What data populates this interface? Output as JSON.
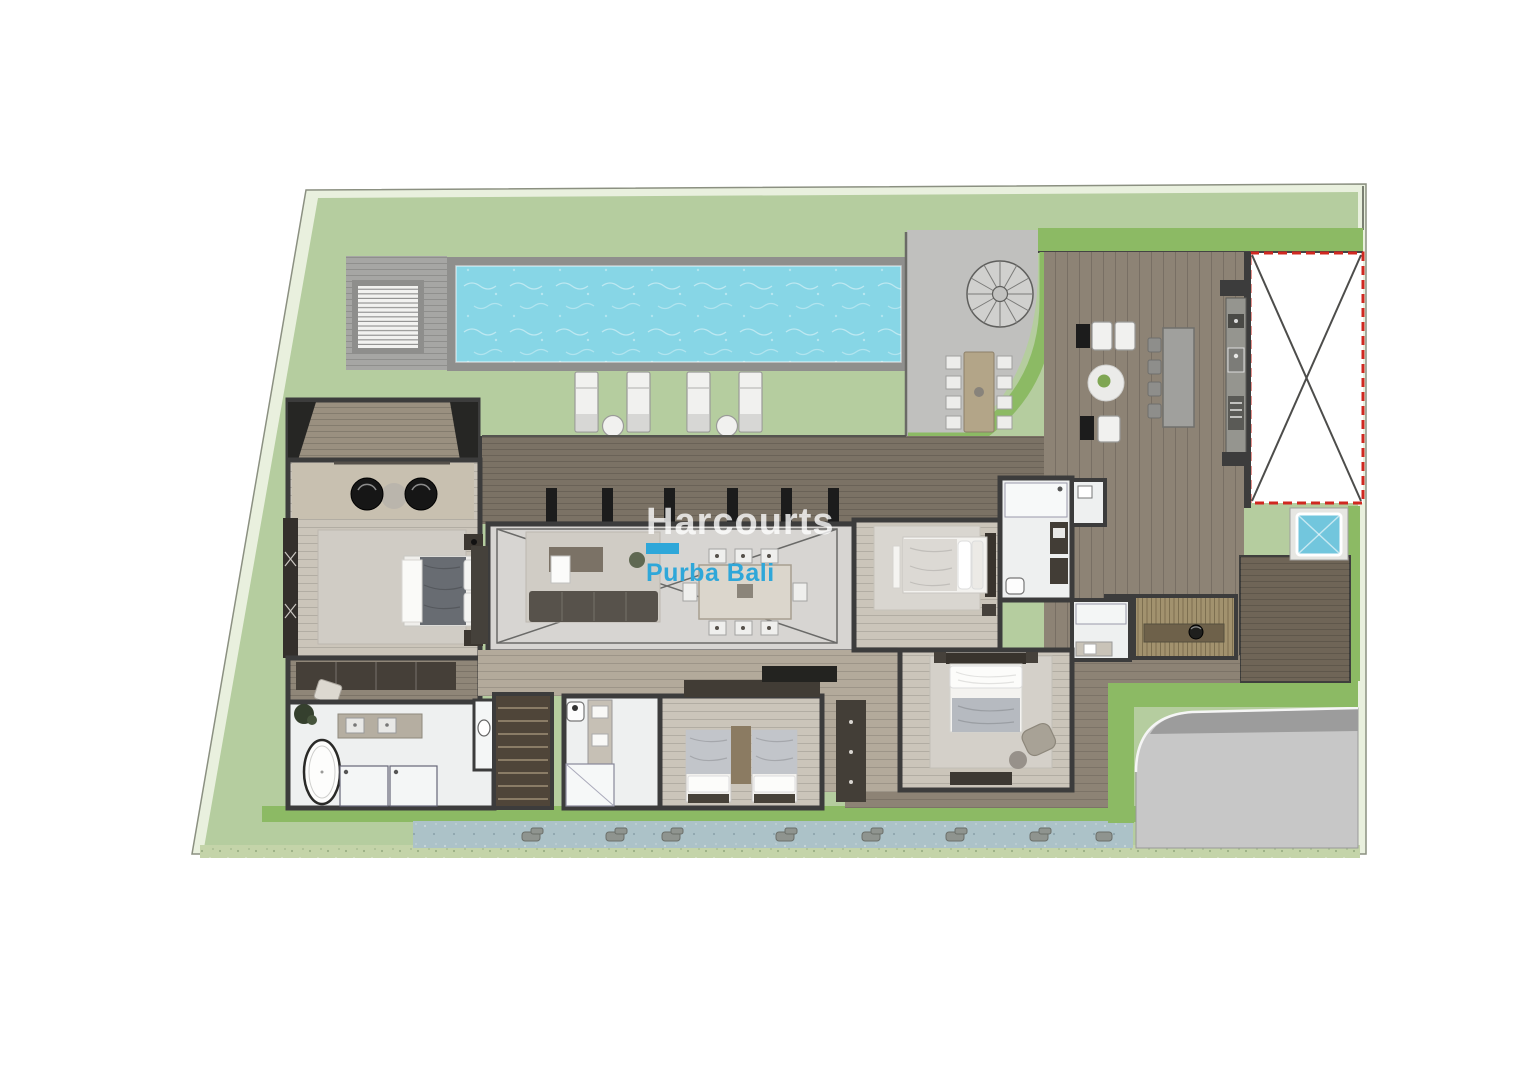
{
  "watermark": {
    "brand": "Harcourts",
    "sub": "Purba Bali"
  },
  "colors": {
    "margin": "#e9f0de",
    "lawn": "#b5cd9f",
    "green2": "#8cba64",
    "pool": "#87d6e6",
    "poolframe": "#8f8f8d",
    "paving": "#c0c0be",
    "deck": "#8d8375",
    "walkway": "#7b7265",
    "darkdeck": "#6f6557",
    "wall": "#3c3c3c",
    "living": "#d7d5d2",
    "bedfloor": "#cbc5ba",
    "bath": "#eef0f0",
    "rug": "#d0ccc5",
    "drive": "#c7c7c7",
    "pond": "#acc2c8",
    "hedge": "#c4d4a9",
    "accent": "#d02820",
    "jacuzzi": "#72c6dd",
    "brand": "#2fa7d9",
    "wmwhite": "rgba(255,255,255,0.78)",
    "terrace": "#9a9080",
    "corridor": "#b3aa9b",
    "stairs": "#4f4539",
    "furnwhite": "#f1f1ef",
    "furndark": "#1c1c1c"
  },
  "plan": {
    "type": "villa-floor-plan",
    "features": [
      "lawn",
      "swimming-pool",
      "pool-deck-louvre",
      "sun-loungers",
      "spiral-staircase",
      "outdoor-dining-table",
      "paved-terrace",
      "carport-void",
      "outdoor-kitchen",
      "kitchen-island",
      "outdoor-lounge",
      "living-room",
      "dining-room",
      "double-height-void",
      "master-terrace",
      "master-bedroom",
      "walk-in-wardrobe",
      "master-bathroom",
      "staircase",
      "guest-bedroom-1",
      "guest-bedroom-2",
      "guest-bedroom-3",
      "ensuite-bathroom-1",
      "ensuite-bathroom-2",
      "ensuite-bathroom-3",
      "sauna",
      "jacuzzi",
      "timber-deck",
      "koi-pond",
      "driveway",
      "hedge"
    ]
  }
}
